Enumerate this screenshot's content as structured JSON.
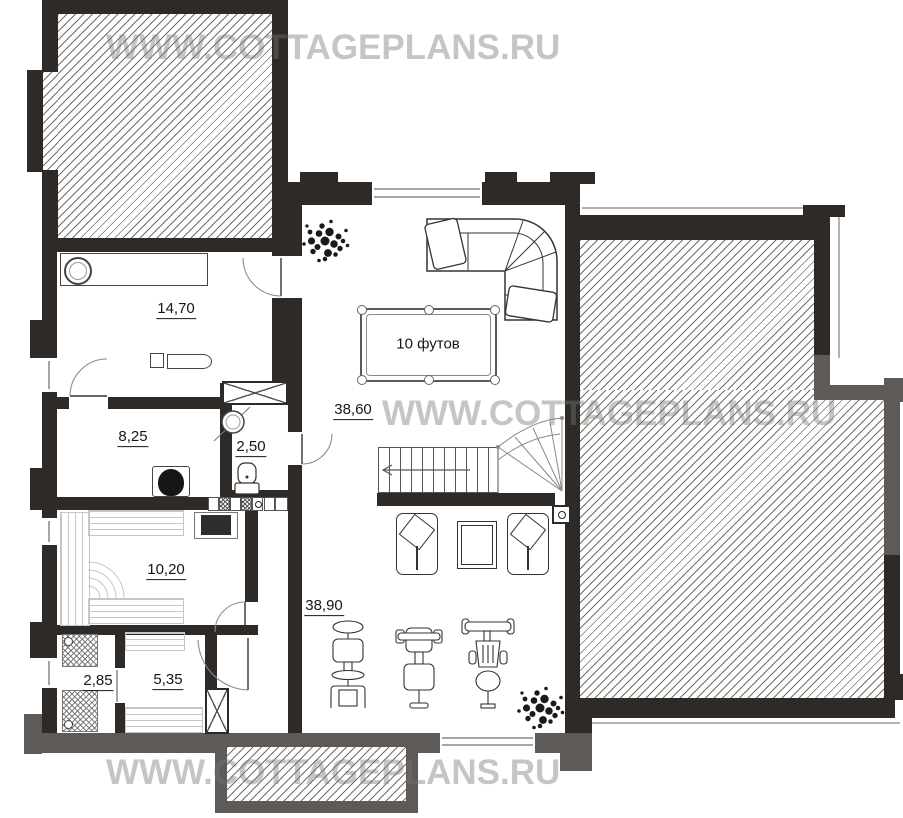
{
  "watermark": {
    "text": "WWW.COTTAGEPLANS.RU"
  },
  "rooms": [
    {
      "name": "boiler-room",
      "area": "14,70"
    },
    {
      "name": "storage-room",
      "area": "8,25"
    },
    {
      "name": "wc",
      "area": "2,50"
    },
    {
      "name": "sauna",
      "area": "10,20"
    },
    {
      "name": "shower-room",
      "area": "2,85"
    },
    {
      "name": "dressing-room",
      "area": "5,35"
    },
    {
      "name": "billiard-hall",
      "area": "38,60"
    },
    {
      "name": "gym-hall",
      "area": "38,90"
    }
  ],
  "billiard_table": {
    "label": "10 футов"
  },
  "colors": {
    "wall_dark": "#2d2a27",
    "wall_gray": "#5d5a57",
    "hatch_line": "#5a554e",
    "watermark": "#767472"
  }
}
